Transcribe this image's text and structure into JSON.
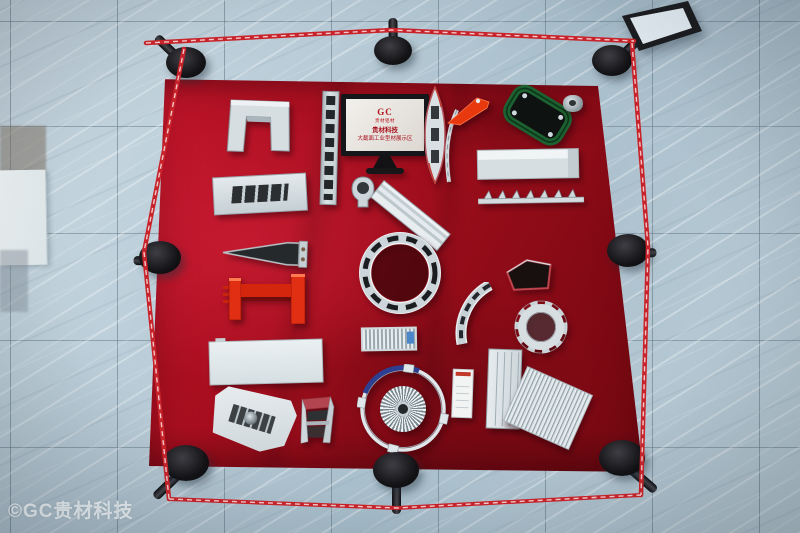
{
  "scene": {
    "description": "Top-down photo of an exhibition display: red velvet table with aluminum extrusion profile samples, surrounded by black stanchions and red barrier tape on blue-gray marble floor",
    "watermark": "©GC贵材科技"
  },
  "sign": {
    "logo_text": "GC",
    "logo_subtext": "贵材铝材",
    "title_line1": "贵材科技",
    "title_line2": "大截面工业型材展示区"
  },
  "palette": {
    "table_red": "#a80f20",
    "tape_red": "#c8232a",
    "floor_tile_blue_gray": "#b7c9d4",
    "stanchion_black": "#141417",
    "aluminum_silver": "#ccd6da",
    "green_profile": "#1d6130",
    "orange_profile": "#e8380d",
    "ibeam_red": "#e02f12",
    "heatsink_band_blue": "#2e3f91"
  },
  "barrier": {
    "stanchion_count": 8,
    "tape_segments": [
      "top",
      "left",
      "right",
      "bottom"
    ],
    "corner_sign_stand": "tilted black-framed sign holder, top-right"
  },
  "table": {
    "items": [
      "u-channel-profile",
      "slotted-rail-profile",
      "display-sign",
      "boat-shaped-profile",
      "orange-bracket-profile",
      "curved-blade-profile",
      "green-frame-profile",
      "round-connector-profile",
      "slotted-flat-bar-profile",
      "handle-profile",
      "ridged-flat-bar-profile",
      "rectangular-box-profile",
      "toothed-rail-profile",
      "tapered-wedge-profile",
      "red-i-beam-profile",
      "slotted-ring-profile",
      "slotted-arc-profile",
      "pentagon-tube-profile",
      "gear-ring-profile",
      "long-white-panel-profile",
      "ribbed-heatsink-profile",
      "turbine-ring-heatsink",
      "spec-card",
      "multichannel-tube-profile",
      "finned-heatsink-profile",
      "complex-extrusion-profile",
      "truss-profile"
    ]
  }
}
